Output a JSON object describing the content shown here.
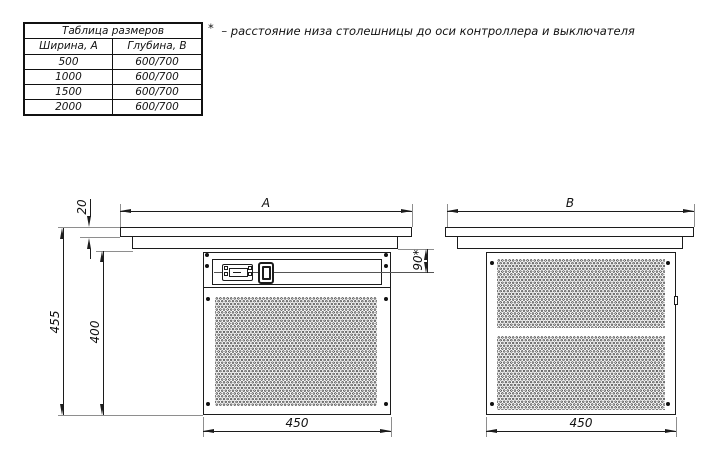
{
  "size_table": {
    "title": "Таблица размеров",
    "col_headers": [
      "Ширина, А",
      "Глубина, В"
    ],
    "rows": [
      [
        "500",
        "600/700"
      ],
      [
        "1000",
        "600/700"
      ],
      [
        "1500",
        "600/700"
      ],
      [
        "2000",
        "600/700"
      ]
    ]
  },
  "footnote": {
    "marker": "*",
    "text": "– расстояние низа столешницы до оси контроллера и выключателя"
  },
  "front_view": {
    "dim_a": "A",
    "dim_top_thickness": "20",
    "dim_overall_height": "455",
    "dim_grille_height": "400",
    "dim_controller_axis": "90*",
    "dim_bottom_width": "450"
  },
  "side_view": {
    "dim_b": "B",
    "dim_bottom_width": "450"
  },
  "colors": {
    "line": "#1c1c1c",
    "extension_line": "#8e8e8e",
    "background": "#ffffff"
  }
}
